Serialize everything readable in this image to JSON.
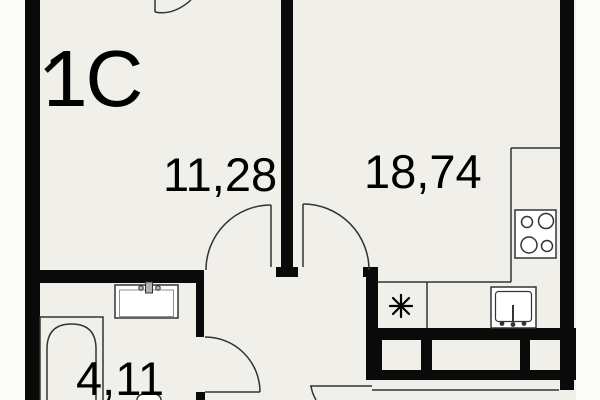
{
  "plan": {
    "type": "apartment-floor-plan",
    "unit": {
      "label": "1C"
    },
    "rooms": [
      {
        "name": "living-kitchen",
        "area": "18,74"
      },
      {
        "name": "room",
        "area": "11,28"
      },
      {
        "name": "bathroom",
        "area": "4,11"
      }
    ],
    "fixtures": [
      "bathtub",
      "washbasin",
      "toilet",
      "stove-4-burners",
      "kitchen-sink",
      "washing-machine-symbol",
      "kitchen-counter",
      "balcony-window-wall",
      "door-arcs"
    ]
  },
  "colors": {
    "wall": "#0a0a0a",
    "floor": "#f0efe9",
    "outside": "#fcfcf9",
    "line": "#333333",
    "fixture_fill": "#ffffff",
    "metal": "#b3b3ac",
    "text": "#000000"
  }
}
